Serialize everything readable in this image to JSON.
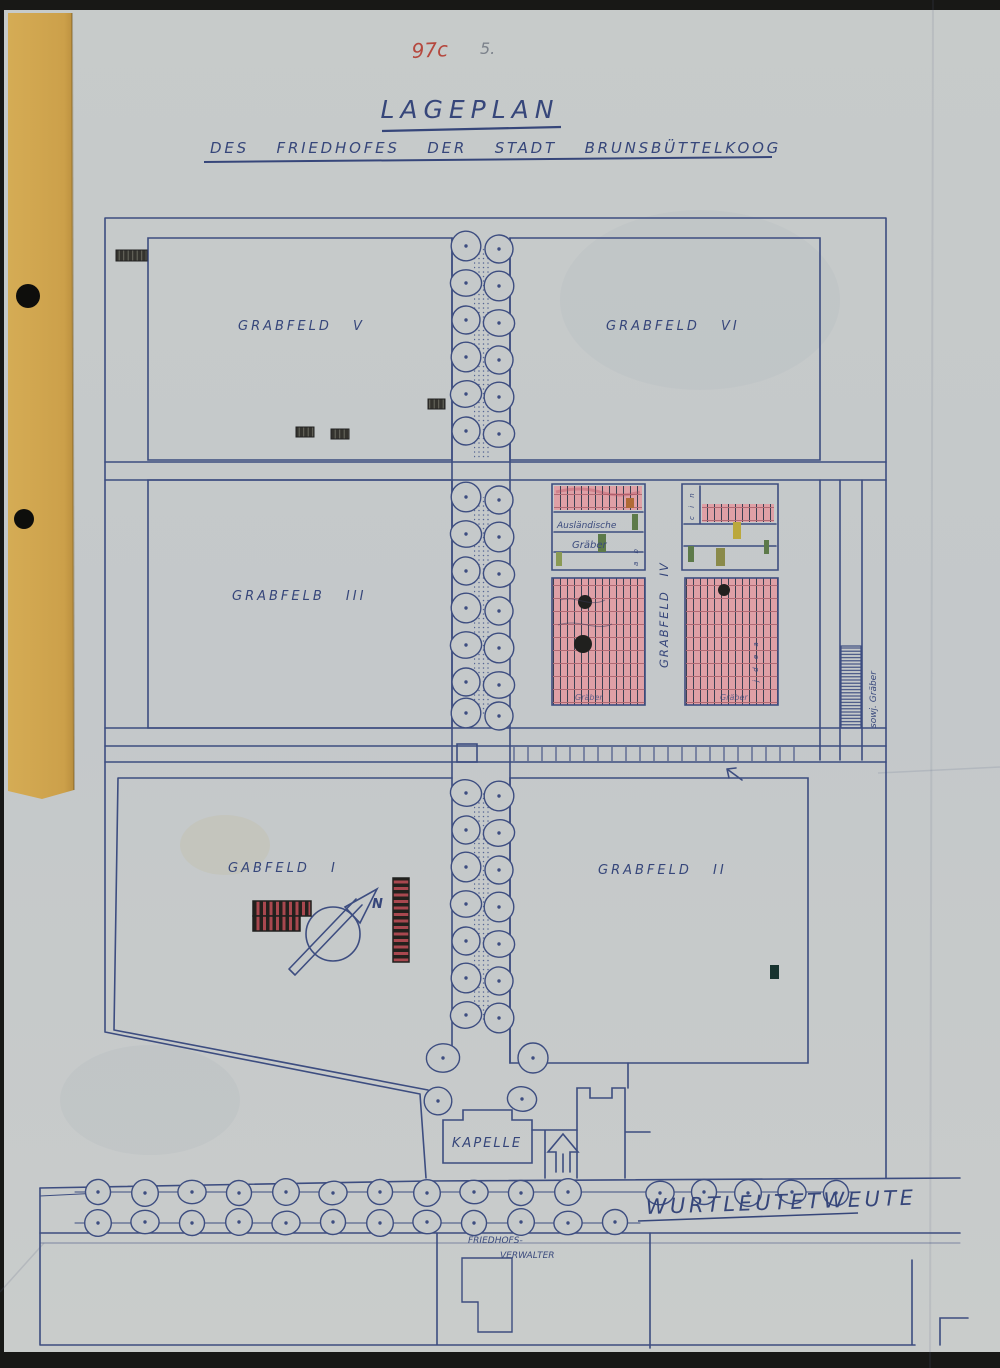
{
  "document": {
    "archival_red_mark": "97c",
    "archival_pencil_mark": "5.",
    "title": "LAGEPLAN",
    "subtitle": "DES FRIEDHOFES DER STADT BRUNSBÜTTELKOOG"
  },
  "map": {
    "fields": {
      "field_v": "GRABFELD V",
      "field_vi": "GRABFELD VI",
      "field_iii": "GRABFELB III",
      "field_iv": "GRABFELD IV",
      "field_i": "GABFELD I",
      "field_ii": "GRABFELD II"
    },
    "labels": {
      "chapel": "KAPELLE",
      "street": "WURTLEUTETWEUTE",
      "caretaker_line1": "FRIEDHOFS-",
      "caretaker_line2": "VERWALTER",
      "foreign_graves_line1": "Ausländische",
      "foreign_graves_line2": "Gräber",
      "soviet_graves": "sowj. Gräber",
      "north_indicator": "N",
      "plot_note_left": "Gräber",
      "plot_note_right": "Gräber",
      "plot_letters_left": "a b",
      "plot_letters_right": "c i n",
      "plot_letters_lower": "j d e a"
    },
    "colors": {
      "paper": "#c5c9ca",
      "ink": "#3d4d80",
      "grave_pink": "#dfa0a6",
      "tape": "#cfa54e",
      "red_mark": "#b5483e",
      "stripe_red": "#a8484f"
    }
  }
}
